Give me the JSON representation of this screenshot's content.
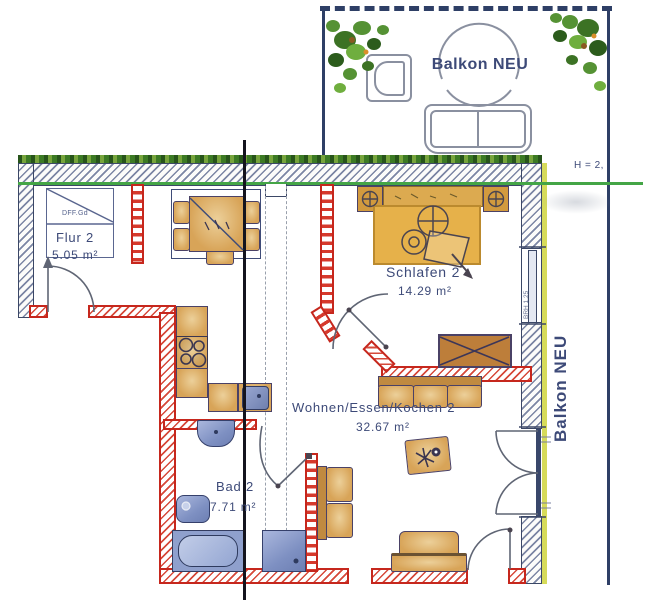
{
  "plan": {
    "balcony": {
      "label": "Balkon NEU",
      "side_label": "Balkon NEU"
    },
    "rooms": {
      "flur": {
        "name": "Flur 2",
        "area": "5.05 m²"
      },
      "schlafen": {
        "name": "Schlafen 2",
        "area": "14.29 m²"
      },
      "wohnen": {
        "name": "Wohnen/Essen/Kochen 2",
        "area": "32.67 m²"
      },
      "bad": {
        "name": "Bad 2",
        "area": "7.71 m²"
      }
    },
    "annotations": {
      "height_note": "H = 2,",
      "closet_label": "DFF.Gd",
      "window_note": "BRH 1.25"
    },
    "colors": {
      "wall_outline": "#3b4766",
      "new_wall_red": "#c6271d",
      "furniture_tan": "#d8a458",
      "bed_gold": "#e6b14a",
      "fixture_blue": "#8fa0cd",
      "greenery": "#4e8a2f",
      "green_line": "#44a546",
      "yellow_strip": "#d6db5a",
      "balcony_outline": "#2e3f66"
    }
  }
}
